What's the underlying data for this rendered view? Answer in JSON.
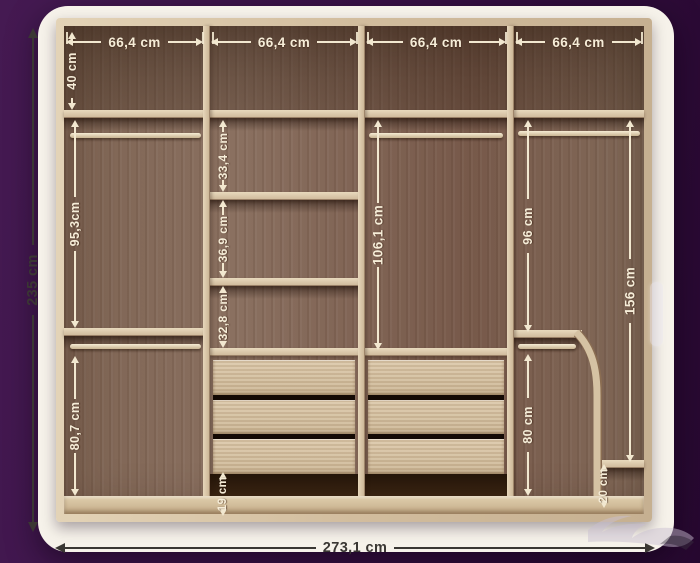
{
  "overall": {
    "height": "235 cm",
    "width": "273,1 cm"
  },
  "top_row": {
    "row_height": "40 cm",
    "section_widths": [
      "66,4 cm",
      "66,4 cm",
      "66,4 cm",
      "66,4 cm"
    ]
  },
  "sections": {
    "left_column": {
      "upper_height": "95,3cm",
      "lower_height": "80,7 cm"
    },
    "shelf_column": {
      "shelf_gaps": [
        "33,4 cm",
        "36,9 cm",
        "32,8 cm"
      ],
      "base_gap": "19 cm"
    },
    "center_column": {
      "hanging_height": "106,1 cm"
    },
    "right_column": {
      "upper_height": "96 cm",
      "lower_height": "80 cm",
      "tall_height": "156 cm",
      "base_shelf_gap": "20 cm"
    }
  },
  "watermark": {
    "logo_text": "حراج"
  },
  "colors": {
    "background": "#2c0b34",
    "card": "#f6f2ea",
    "wood_light": "#d8c5a8",
    "wood_dark": "#7b6150",
    "dimension_light": "#f2e8d0",
    "dimension_dark": "#3a3733"
  }
}
